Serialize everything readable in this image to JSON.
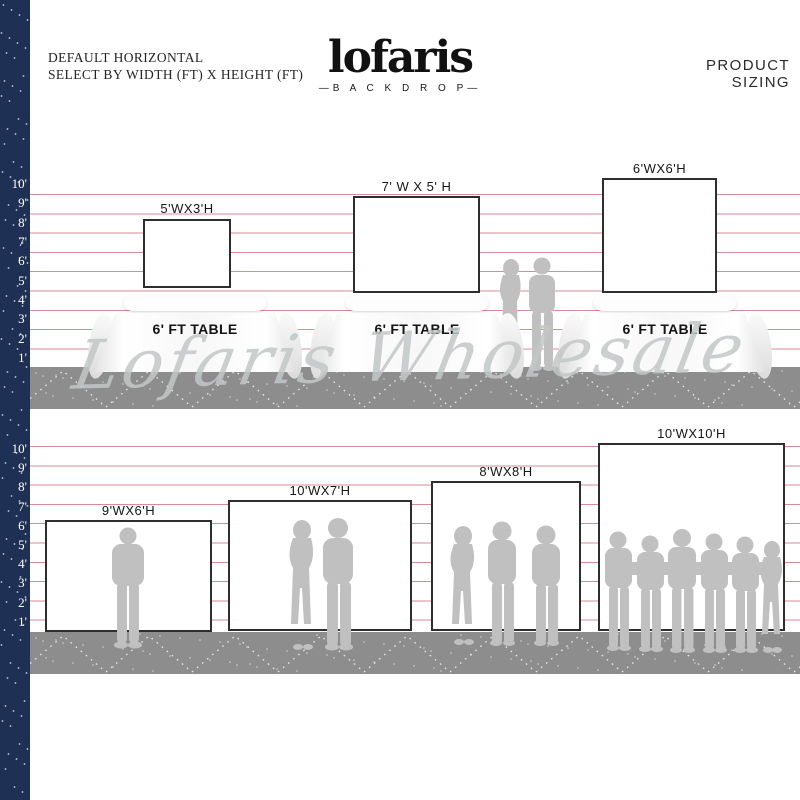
{
  "header": {
    "line1": "DEFAULT HORIZONTAL",
    "line2": "SELECT BY WIDTH (FT) X HEIGHT (FT)"
  },
  "logo": {
    "name": "lofaris",
    "tagline": "—B A C K D R O P—"
  },
  "title_right": "PRODUCT SIZING",
  "watermark": "Lofaris Wholesale",
  "ruler_feet": [
    "10'",
    "9'",
    "8'",
    "7'",
    "6'",
    "5'",
    "4'",
    "3'",
    "2'",
    "1'"
  ],
  "row1": {
    "table_label": "6' FT TABLE",
    "backdrops": [
      {
        "label": "5'WX3'H"
      },
      {
        "label": "7' W X 5' H"
      },
      {
        "label": "6'WX6'H"
      }
    ]
  },
  "row2": {
    "backdrops": [
      {
        "label": "9'WX6'H"
      },
      {
        "label": "10'WX7'H"
      },
      {
        "label": "8'WX8'H"
      },
      {
        "label": "10'WX10'H"
      }
    ]
  },
  "colors": {
    "strip_navy": "#1e3054",
    "ruler_line_pink": "#d98b95",
    "floor_gray": "#8d8d8d",
    "silhouette_gray": "#c0c0c0",
    "backdrop_border": "#2e2e2e",
    "watermark_gray": "#c3c7c7"
  }
}
